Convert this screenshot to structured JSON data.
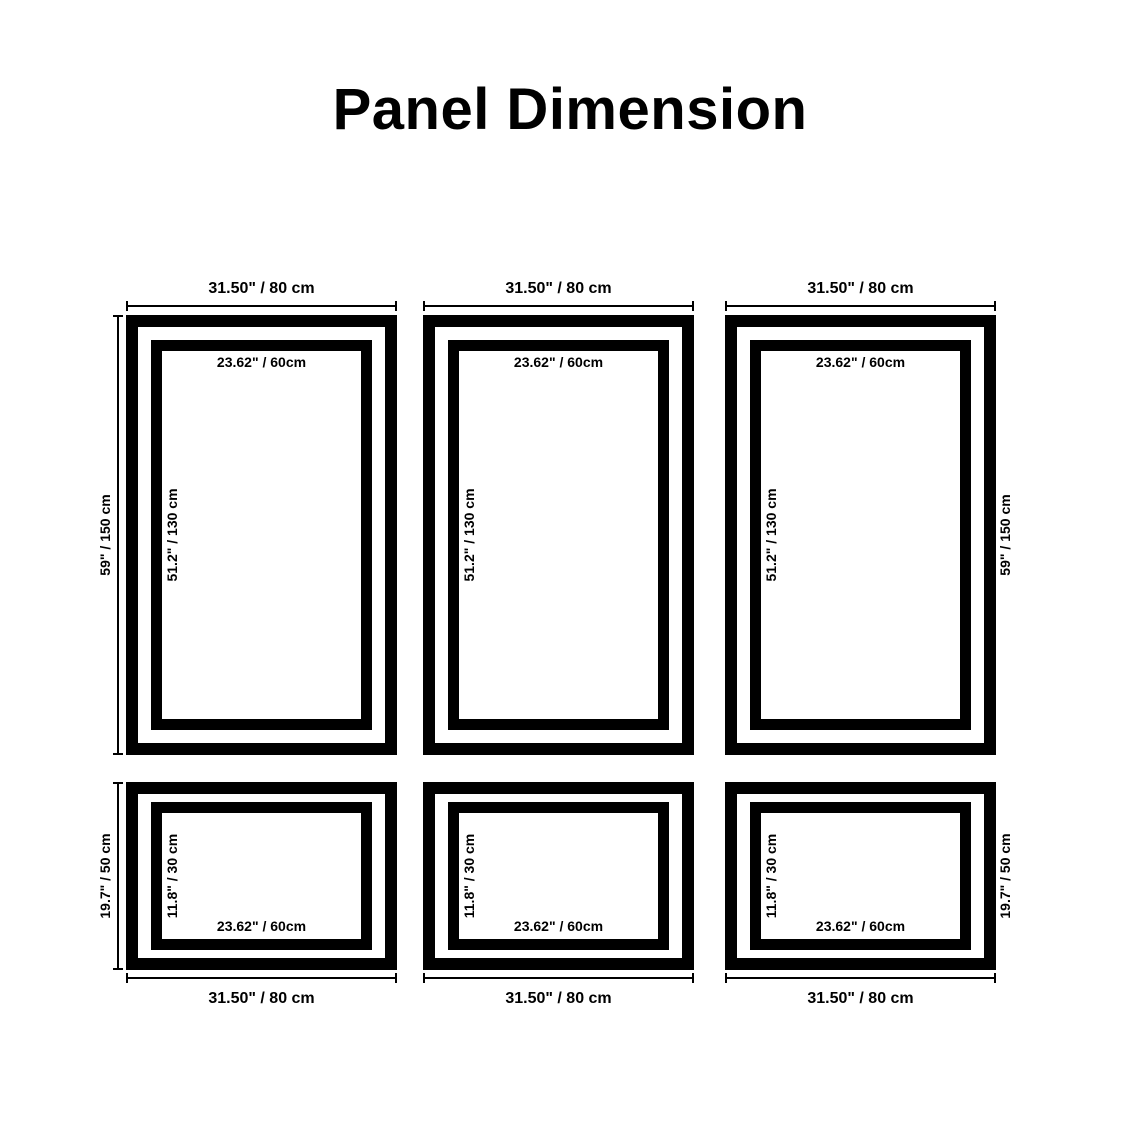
{
  "title": "Panel Dimension",
  "colors": {
    "frame": "#000000",
    "text": "#000000",
    "background": "#ffffff"
  },
  "panels": [
    {
      "name": "top-left",
      "outer_width_label": "31.50\" / 80 cm",
      "inner_width_label": "23.62\" / 60cm",
      "inner_height_label": "51.2\" / 130 cm",
      "outer_height_label": "59\" / 150 cm",
      "outer_height_side": "left"
    },
    {
      "name": "top-center",
      "outer_width_label": "31.50\" / 80 cm",
      "inner_width_label": "23.62\" / 60cm",
      "inner_height_label": "51.2\" / 130 cm"
    },
    {
      "name": "top-right",
      "outer_width_label": "31.50\" / 80 cm",
      "inner_width_label": "23.62\" / 60cm",
      "inner_height_label": "51.2\" / 130 cm",
      "outer_height_label": "59\" / 150 cm",
      "outer_height_side": "right"
    },
    {
      "name": "bottom-left",
      "outer_width_label": "31.50\" / 80 cm",
      "inner_width_label": "23.62\" / 60cm",
      "inner_height_label": "11.8\" / 30 cm",
      "outer_height_label": "19.7\" / 50 cm",
      "outer_height_side": "left"
    },
    {
      "name": "bottom-center",
      "outer_width_label": "31.50\" / 80 cm",
      "inner_width_label": "23.62\" / 60cm",
      "inner_height_label": "11.8\" / 30 cm"
    },
    {
      "name": "bottom-right",
      "outer_width_label": "31.50\" / 80 cm",
      "inner_width_label": "23.62\" / 60cm",
      "inner_height_label": "11.8\" / 30 cm",
      "outer_height_label": "19.7\" / 50 cm",
      "outer_height_side": "right"
    }
  ]
}
